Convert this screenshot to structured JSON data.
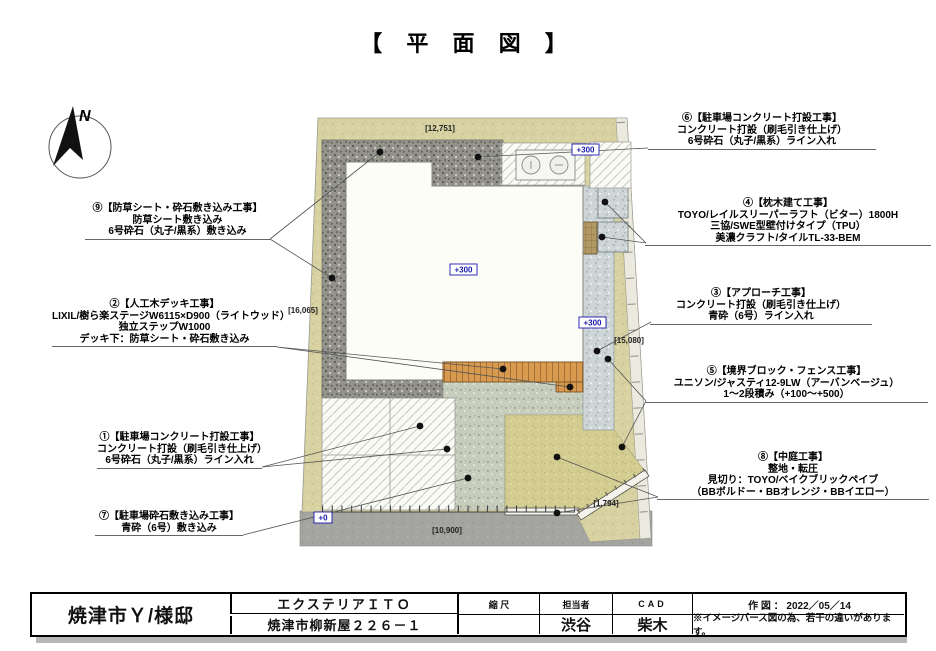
{
  "title": "【 平 面 図 】",
  "compass": {
    "north_label": "N"
  },
  "callouts": {
    "c9": {
      "lines": [
        "⑨【防草シート・砕石敷き込み工事】",
        "防草シート敷き込み",
        "6号砕石（丸子/黒系）敷き込み"
      ]
    },
    "c2": {
      "lines": [
        "②【人工木デッキ工事】",
        "LIXIL/樹ら楽ステージW6115×D900（ライトウッド）",
        "独立ステップW1000",
        "デッキ下：防草シート・砕石敷き込み"
      ]
    },
    "c1": {
      "lines": [
        "①【駐車場コンクリート打設工事】",
        "コンクリート打設（刷毛引き仕上げ）",
        "6号砕石（丸子/黒系）ライン入れ"
      ]
    },
    "c7": {
      "lines": [
        "⑦【駐車場砕石敷き込み工事】",
        "青砕（6号）敷き込み"
      ]
    },
    "c6": {
      "lines": [
        "⑥【駐車場コンクリート打設工事】",
        "コンクリート打設（刷毛引き仕上げ）",
        "6号砕石（丸子/黒系）ライン入れ"
      ]
    },
    "c4": {
      "lines": [
        "④【枕木建て工事】",
        "TOYO/レイルスリーパーラフト（ビター）1800H",
        "三協/SWE型壁付けタイプ（TPU）",
        "美濃クラフト/タイルTL-33-BEM"
      ]
    },
    "c3": {
      "lines": [
        "③【アプローチ工事】",
        "コンクリート打設（刷毛引き仕上げ）",
        "青砕（6号）ライン入れ"
      ]
    },
    "c5": {
      "lines": [
        "⑤【境界ブロック・フェンス工事】",
        "ユニソン/ジャスティ12-9LW（アーバンベージュ）",
        "1～2段積み（+100～+500）"
      ]
    },
    "c8": {
      "lines": [
        "⑧【中庭工事】",
        "整地・転圧",
        "見切り：TOYO/ベイクブリックペイブ",
        "（BBボルドー・BBオレンジ・BBイエロー）"
      ]
    }
  },
  "plan": {
    "elevations": {
      "plus300": "+300",
      "zero": "+0"
    },
    "dimensions": {
      "top": "[12,751]",
      "left": "[16,065]",
      "right": "[15,080]",
      "bottom": "[10,900]",
      "corner": "[1,794]"
    }
  },
  "titleblock": {
    "project": "焼津市Ｙ/様邸",
    "company": "エクステリアＩＴＯ",
    "address": "焼津市柳新屋２２６－１",
    "scale_label": "縮 尺",
    "manager_label": "担当者",
    "manager": "渋谷",
    "cad_label": "CAD",
    "cad": "柴木",
    "date_label": "作 図 ： 2022／05／14",
    "note": "※イメージパース図の為、若干の違いがあります。"
  },
  "colors": {
    "elevation_blue": "#1a1aad",
    "site_tan": "#d8d2a2",
    "gravel_dark": "#93938b",
    "gravel_green": "#c6cdbd",
    "approach_gray": "#cdd5d6",
    "deck_wood": "#d79a4f",
    "road_gray": "#a4a4a0"
  }
}
